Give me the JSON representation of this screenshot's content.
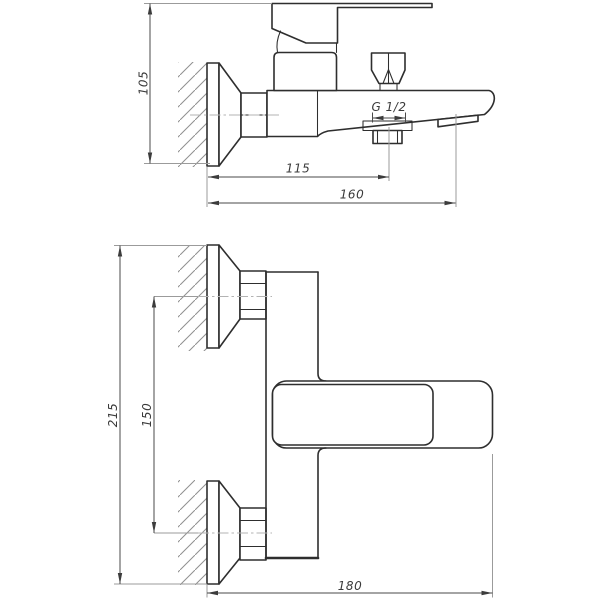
{
  "side_view": {
    "dim_height": "105",
    "dim_wall_to_shower_outlet": "115",
    "dim_wall_to_spout_outlet": "160",
    "thread_label": "G 1/2"
  },
  "front_view": {
    "dim_overall_height": "215",
    "dim_mounting_centers": "150",
    "dim_overall_reach": "180"
  },
  "colors": {
    "background": "#ffffff",
    "object_line": "#2e2e2e",
    "dimension_line": "#4a4a4a",
    "extension_line": "#9b9b9b",
    "centerline": "#b3b3b3",
    "hatch": "#8f8f8f"
  }
}
